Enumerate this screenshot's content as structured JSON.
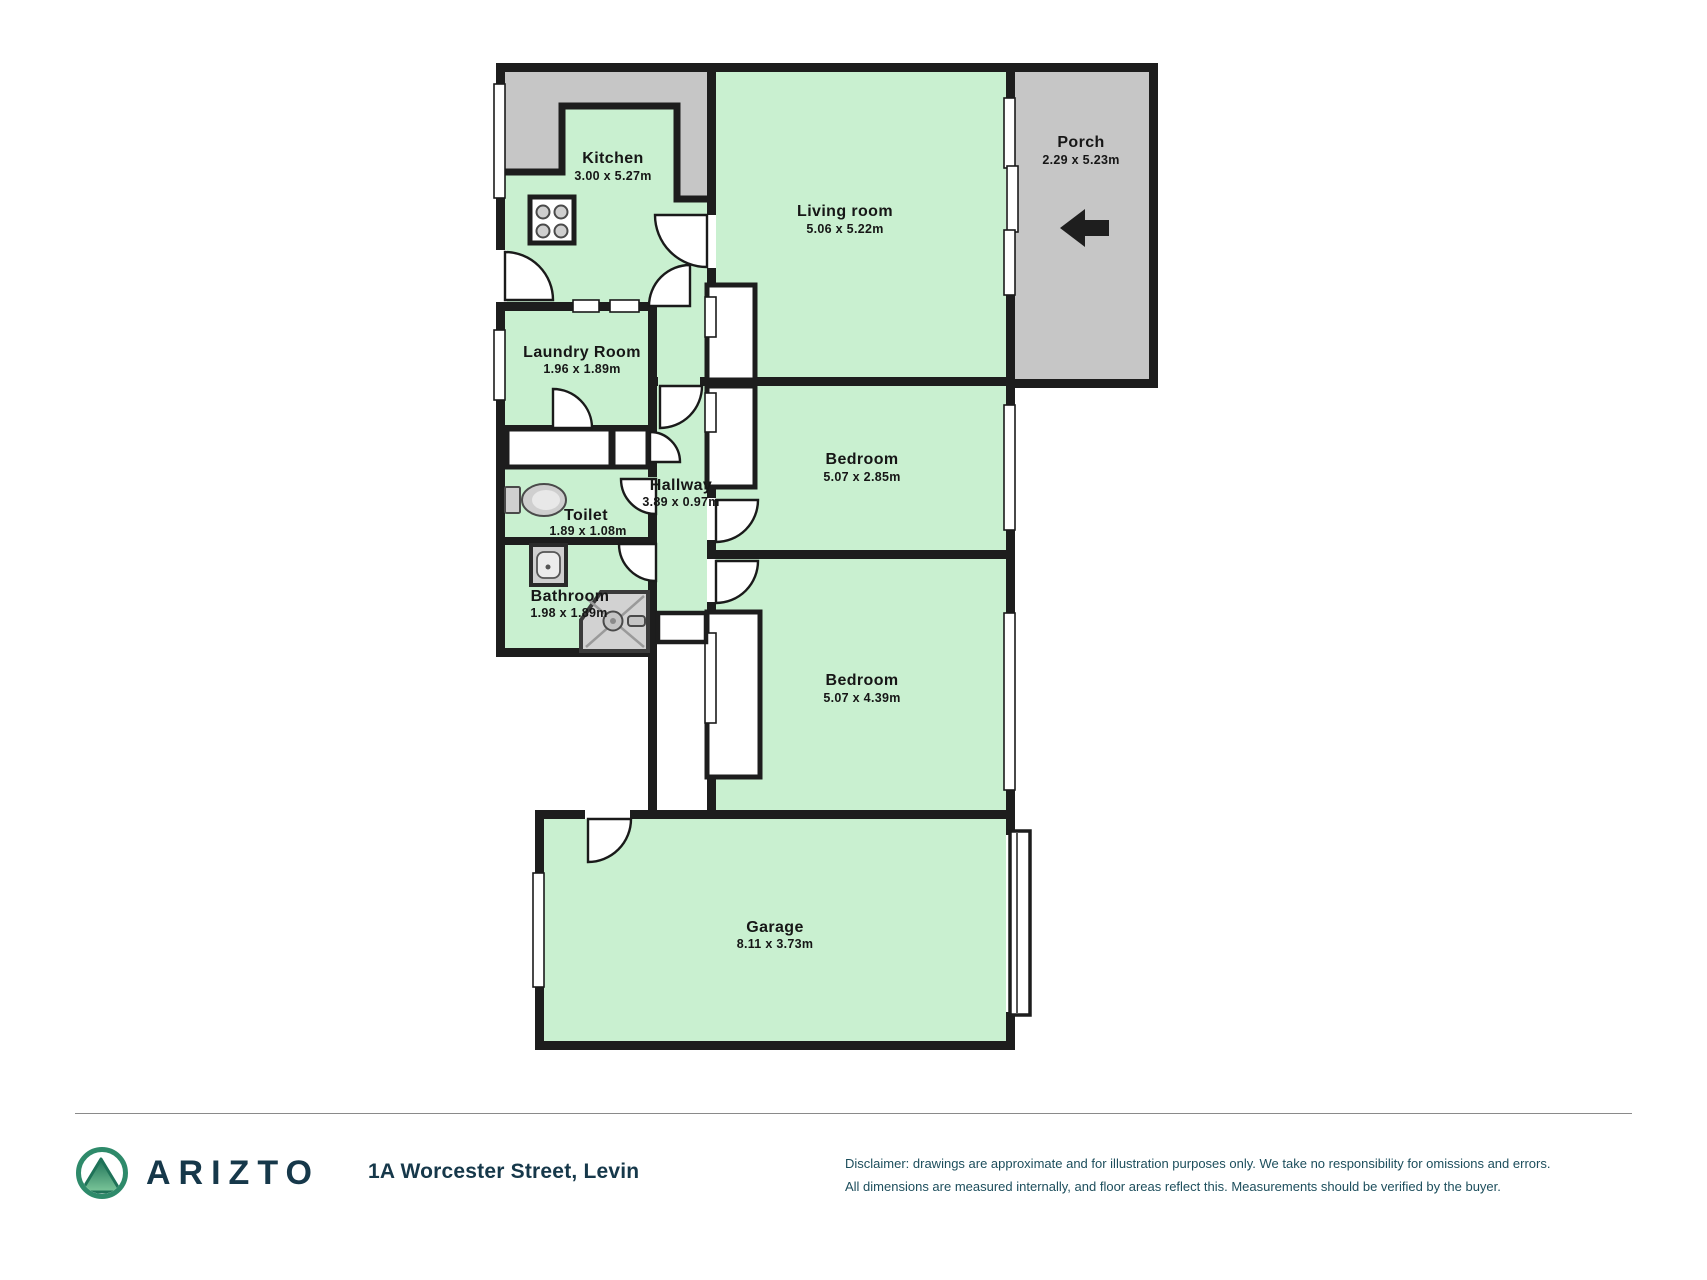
{
  "plan": {
    "rooms": {
      "kitchen": {
        "name": "Kitchen",
        "dims": "3.00 x 5.27m"
      },
      "living": {
        "name": "Living room",
        "dims": "5.06 x 5.22m"
      },
      "porch": {
        "name": "Porch",
        "dims": "2.29 x 5.23m"
      },
      "laundry": {
        "name": "Laundry Room",
        "dims": "1.96 x 1.89m"
      },
      "hallway": {
        "name": "Hallway",
        "dims": "3.89 x 0.97m"
      },
      "toilet": {
        "name": "Toilet",
        "dims": "1.89 x 1.08m"
      },
      "bathroom": {
        "name": "Bathroom",
        "dims": "1.98 x 1.89m"
      },
      "bedroom1": {
        "name": "Bedroom",
        "dims": "5.07 x 2.85m"
      },
      "bedroom2": {
        "name": "Bedroom",
        "dims": "5.07 x 4.39m"
      },
      "garage": {
        "name": "Garage",
        "dims": "8.11 x 3.73m"
      }
    },
    "icons": {
      "entry_arrow_direction": "left"
    }
  },
  "footer": {
    "brand": "ARIZTO",
    "address": "1A Worcester Street, Levin",
    "disclaimer_line1": "Disclaimer: drawings are approximate and for illustration purposes only. We take no responsibility for omissions and errors.",
    "disclaimer_line2": "All dimensions are measured internally, and floor areas reflect this. Measurements should be verified by the buyer."
  },
  "colors": {
    "room_fill": "#c9f0d0",
    "outdoor_fill": "#c6c6c6",
    "wall": "#1d1d1d",
    "fixture_fill": "#cfcfcf",
    "brand_color": "#16384a",
    "disclaimer_color": "#1d4e5c",
    "logo_ring": "#2e8a6a",
    "logo_green_dark": "#1f7258",
    "logo_green_light": "#7cc79a"
  }
}
